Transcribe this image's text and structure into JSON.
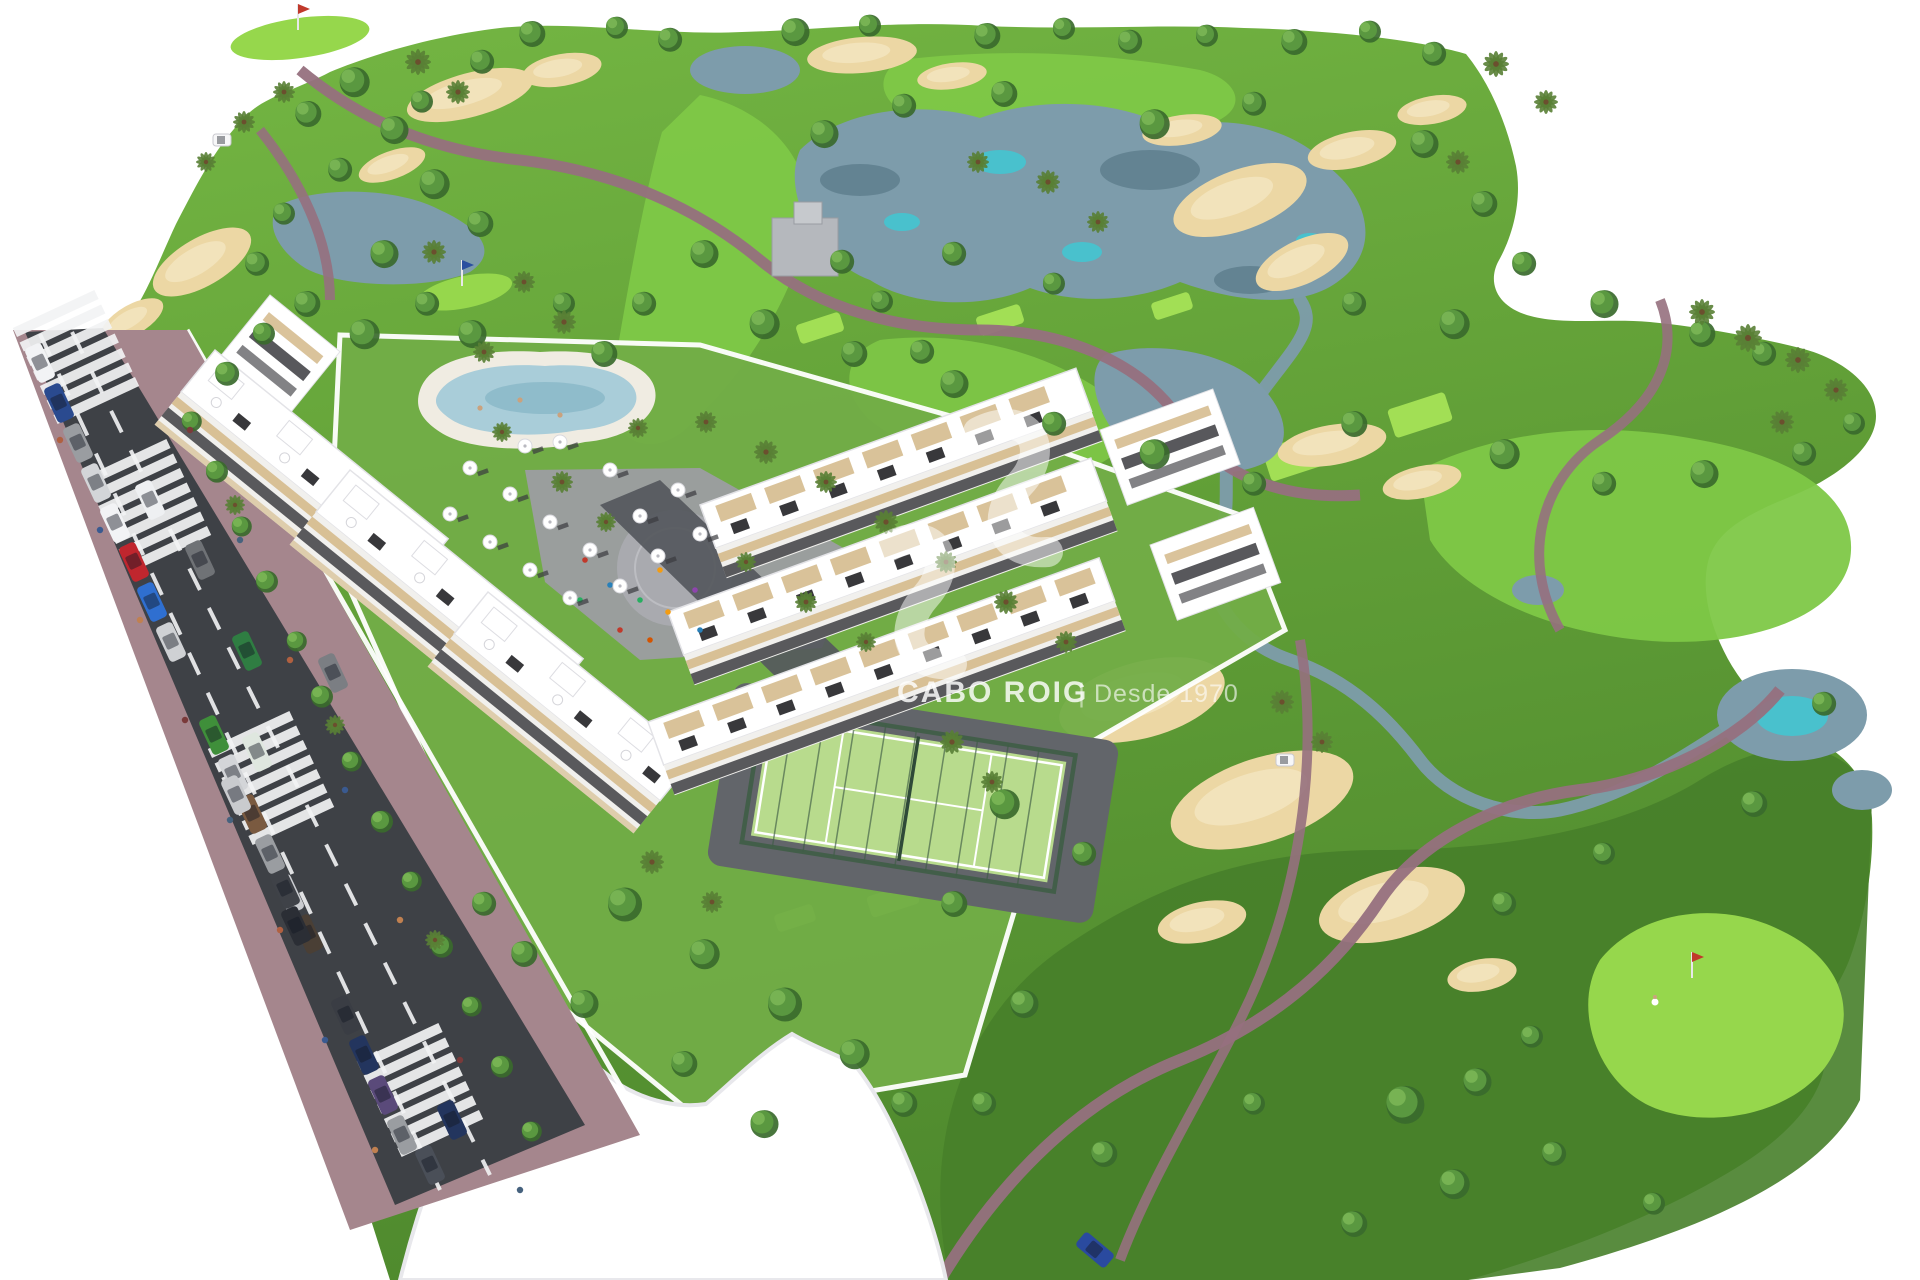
{
  "watermark": {
    "brand": "CABO ROIG",
    "divider": "|",
    "tagline": "Desde 1970",
    "logo": "sv-swoosh-icon"
  },
  "palette": {
    "bg": "#ffffff",
    "course_top": "#74b643",
    "course_mid": "#619f37",
    "course_low": "#4f8a2e",
    "rough_dark": "#47802a",
    "fairway": "#7ec847",
    "green_bright": "#96d74c",
    "tee": "#a2df55",
    "sand": "#ecd7a4",
    "sand_light": "#f4e6c0",
    "water": "#7d9cab",
    "water_deep": "#5d7d8c",
    "water_teal": "#3fc8d2",
    "path": "#96707e",
    "road": "#3e4146",
    "road_line": "#f2f3f4",
    "sidewalk": "#a5868d",
    "parcel": "#72ad47",
    "wall": "#ffffff",
    "wall_shadow": "#e8e8ec",
    "plaza": "#9c9da2",
    "plaza_inner": "#a9aaaf",
    "pool_deck": "#f0ece2",
    "pool_water": "#a9cdd9",
    "pool_deep": "#7fb0c2",
    "court": "#b8db8d",
    "court_line": "#ffffff",
    "fence": "#3f5d46",
    "apron": "#62656a",
    "drive": "#55585d",
    "building": "#ffffff",
    "building_line": "#e3e3e7",
    "facade_shade": "#f1f0ed",
    "facade_beige": "#d6bd90",
    "window_dark": "#2e2e33",
    "panel_black": "#1d1d20",
    "tree_dark": "#3a6a2d",
    "tree_mid": "#5a9840",
    "tree_light": "#7cb757",
    "palm": "#597f35",
    "trunk": "#6b4f2e",
    "stone": "#b5b8bd",
    "cart": "#f7f7f8",
    "skin": "#caa27e"
  },
  "scene": {
    "trees": [
      [
        530,
        32,
        13
      ],
      [
        615,
        26,
        11
      ],
      [
        668,
        38,
        12
      ],
      [
        793,
        30,
        14
      ],
      [
        868,
        24,
        11
      ],
      [
        985,
        34,
        13
      ],
      [
        1062,
        27,
        11
      ],
      [
        1128,
        40,
        12
      ],
      [
        1205,
        34,
        11
      ],
      [
        1292,
        40,
        13
      ],
      [
        1368,
        30,
        11
      ],
      [
        1432,
        52,
        12
      ],
      [
        480,
        60,
        12
      ],
      [
        420,
        100,
        11
      ],
      [
        352,
        80,
        15
      ],
      [
        306,
        112,
        13
      ],
      [
        392,
        128,
        14
      ],
      [
        338,
        168,
        12
      ],
      [
        432,
        182,
        15
      ],
      [
        478,
        222,
        13
      ],
      [
        282,
        212,
        11
      ],
      [
        255,
        262,
        12
      ],
      [
        382,
        252,
        14
      ],
      [
        305,
        302,
        13
      ],
      [
        362,
        332,
        15
      ],
      [
        425,
        302,
        12
      ],
      [
        262,
        332,
        11
      ],
      [
        225,
        372,
        12
      ],
      [
        470,
        332,
        14
      ],
      [
        822,
        132,
        14
      ],
      [
        902,
        104,
        12
      ],
      [
        1002,
        92,
        13
      ],
      [
        1152,
        122,
        15
      ],
      [
        1252,
        102,
        12
      ],
      [
        1422,
        142,
        14
      ],
      [
        1482,
        202,
        13
      ],
      [
        1522,
        262,
        12
      ],
      [
        1602,
        302,
        14
      ],
      [
        1700,
        332,
        13
      ],
      [
        1762,
        352,
        12
      ],
      [
        1452,
        322,
        15
      ],
      [
        1352,
        302,
        12
      ],
      [
        1052,
        282,
        11
      ],
      [
        952,
        252,
        12
      ],
      [
        702,
        252,
        14
      ],
      [
        642,
        302,
        12
      ],
      [
        602,
        352,
        13
      ],
      [
        562,
        302,
        11
      ],
      [
        762,
        322,
        15
      ],
      [
        852,
        352,
        13
      ],
      [
        952,
        382,
        14
      ],
      [
        1052,
        422,
        12
      ],
      [
        1152,
        452,
        15
      ],
      [
        1252,
        482,
        12
      ],
      [
        1352,
        422,
        13
      ],
      [
        1502,
        452,
        15
      ],
      [
        1602,
        482,
        12
      ],
      [
        1702,
        472,
        14
      ],
      [
        1802,
        452,
        12
      ],
      [
        1852,
        422,
        11
      ],
      [
        920,
        350,
        12
      ],
      [
        880,
        300,
        11
      ],
      [
        840,
        260,
        12
      ],
      [
        1002,
        802,
        15
      ],
      [
        1082,
        852,
        12
      ],
      [
        952,
        902,
        13
      ],
      [
        1022,
        1002,
        14
      ],
      [
        982,
        1102,
        12
      ],
      [
        1102,
        1152,
        13
      ],
      [
        1252,
        1102,
        11
      ],
      [
        1402,
        1102,
        19
      ],
      [
        1452,
        1182,
        15
      ],
      [
        1352,
        1222,
        13
      ],
      [
        1552,
        1152,
        12
      ],
      [
        1652,
        1202,
        11
      ],
      [
        1502,
        902,
        12
      ],
      [
        1602,
        852,
        11
      ],
      [
        1752,
        802,
        13
      ],
      [
        1822,
        702,
        12
      ],
      [
        1475,
        1080,
        14
      ],
      [
        1530,
        1035,
        11
      ],
      [
        622,
        902,
        17
      ],
      [
        702,
        952,
        15
      ],
      [
        782,
        1002,
        17
      ],
      [
        852,
        1052,
        15
      ],
      [
        902,
        1102,
        13
      ],
      [
        762,
        1122,
        14
      ],
      [
        682,
        1062,
        13
      ],
      [
        582,
        1002,
        14
      ],
      [
        522,
        952,
        13
      ],
      [
        482,
        902,
        12
      ],
      [
        190,
        420,
        10
      ],
      [
        215,
        470,
        11
      ],
      [
        240,
        525,
        10
      ],
      [
        265,
        580,
        11
      ],
      [
        295,
        640,
        10
      ],
      [
        320,
        695,
        11
      ],
      [
        350,
        760,
        10
      ],
      [
        380,
        820,
        11
      ],
      [
        410,
        880,
        10
      ],
      [
        440,
        945,
        11
      ],
      [
        470,
        1005,
        10
      ],
      [
        500,
        1065,
        11
      ],
      [
        530,
        1130,
        10
      ]
    ],
    "palms": [
      [
        418,
        62,
        13
      ],
      [
        458,
        92,
        12
      ],
      [
        1496,
        64,
        13
      ],
      [
        1546,
        102,
        12
      ],
      [
        1458,
        162,
        12
      ],
      [
        244,
        122,
        11
      ],
      [
        206,
        162,
        10
      ],
      [
        284,
        92,
        11
      ],
      [
        1702,
        312,
        13
      ],
      [
        1748,
        338,
        14
      ],
      [
        1798,
        360,
        13
      ],
      [
        1836,
        390,
        12
      ],
      [
        1782,
        422,
        12
      ],
      [
        434,
        252,
        12
      ],
      [
        524,
        282,
        11
      ],
      [
        564,
        322,
        12
      ],
      [
        484,
        352,
        11
      ],
      [
        638,
        428,
        10
      ],
      [
        1048,
        182,
        12
      ],
      [
        1098,
        222,
        11
      ],
      [
        978,
        162,
        11
      ],
      [
        706,
        422,
        11
      ],
      [
        766,
        452,
        12
      ],
      [
        826,
        482,
        11
      ],
      [
        886,
        522,
        12
      ],
      [
        946,
        562,
        11
      ],
      [
        1006,
        602,
        12
      ],
      [
        1066,
        642,
        11
      ],
      [
        746,
        562,
        10
      ],
      [
        806,
        602,
        11
      ],
      [
        866,
        642,
        10
      ],
      [
        562,
        482,
        11
      ],
      [
        606,
        522,
        10
      ],
      [
        502,
        432,
        10
      ],
      [
        1282,
        702,
        12
      ],
      [
        1322,
        742,
        11
      ],
      [
        652,
        862,
        12
      ],
      [
        712,
        902,
        11
      ],
      [
        952,
        742,
        12
      ],
      [
        992,
        782,
        11
      ],
      [
        235,
        505,
        10
      ],
      [
        335,
        725,
        10
      ],
      [
        435,
        940,
        10
      ]
    ],
    "cars_parked": [
      [
        40,
        363,
        "#f2f3f5"
      ],
      [
        59,
        403,
        "#2a4a8f"
      ],
      [
        78,
        443,
        "#9a9da1"
      ],
      [
        96,
        483,
        "#d3d5d8"
      ],
      [
        115,
        523,
        "#f2f3f5"
      ],
      [
        134,
        562,
        "#c0262e"
      ],
      [
        152,
        602,
        "#2f6fd0"
      ],
      [
        171,
        642,
        "#cfd1d4"
      ],
      [
        214,
        735,
        "#3f8f3a"
      ],
      [
        233,
        774,
        "#d3d5d8"
      ],
      [
        252,
        814,
        "#7a5a40"
      ],
      [
        270,
        854,
        "#9a9da1"
      ],
      [
        289,
        894,
        "#caccd0"
      ],
      [
        308,
        934,
        "#4a3f35"
      ],
      [
        346,
        1015,
        "#3a3d44"
      ],
      [
        364,
        1055,
        "#23355e"
      ],
      [
        383,
        1095,
        "#5a4a7a"
      ],
      [
        402,
        1135,
        "#9a9da1"
      ]
    ],
    "cars_moving": [
      [
        150,
        500,
        "#eef0f2"
      ],
      [
        200,
        560,
        "#6f7276"
      ],
      [
        247,
        651,
        "#2f7d42"
      ],
      [
        257,
        752,
        "#dfe7df"
      ],
      [
        236,
        795,
        "#c9cbce"
      ],
      [
        285,
        889,
        "#3f4248"
      ],
      [
        296,
        926,
        "#2b2e35"
      ],
      [
        452,
        1120,
        "#23355e"
      ],
      [
        430,
        1165,
        "#4a4f58"
      ],
      [
        333,
        673,
        "#7b7e83"
      ],
      [
        1095,
        1250,
        "#2a4a9f",
        40
      ]
    ],
    "crosswalks": [
      [
        76,
        357
      ],
      [
        148,
        506
      ],
      [
        271,
        778
      ],
      [
        420,
        1090
      ]
    ],
    "pedestrians": [
      [
        60,
        440,
        "#b06040"
      ],
      [
        100,
        530,
        "#3a5a90"
      ],
      [
        140,
        620,
        "#c08050"
      ],
      [
        185,
        720,
        "#7a3a3a"
      ],
      [
        230,
        820,
        "#46627e"
      ],
      [
        280,
        930,
        "#b06040"
      ],
      [
        325,
        1040,
        "#3a5a90"
      ],
      [
        375,
        1150,
        "#c08050"
      ],
      [
        190,
        430,
        "#7a3a3a"
      ],
      [
        240,
        540,
        "#46627e"
      ],
      [
        290,
        660,
        "#b06040"
      ],
      [
        345,
        790,
        "#3a5a90"
      ],
      [
        400,
        920,
        "#c08050"
      ],
      [
        460,
        1060,
        "#7a3a3a"
      ],
      [
        520,
        1190,
        "#46627e"
      ]
    ],
    "plaza_people": [
      [
        585,
        560
      ],
      [
        610,
        585
      ],
      [
        640,
        600
      ],
      [
        668,
        612
      ],
      [
        695,
        590
      ],
      [
        650,
        640
      ],
      [
        620,
        630
      ],
      [
        700,
        630
      ],
      [
        580,
        600
      ],
      [
        660,
        570
      ]
    ],
    "people_colors": [
      "#c0392b",
      "#2980b9",
      "#27ae60",
      "#f39c12",
      "#8e44ad",
      "#d35400"
    ],
    "pool_people": [
      [
        520,
        400
      ],
      [
        560,
        415
      ],
      [
        480,
        408
      ]
    ],
    "umbrellas": [
      [
        470,
        468
      ],
      [
        510,
        494
      ],
      [
        550,
        522
      ],
      [
        590,
        550
      ],
      [
        450,
        514
      ],
      [
        490,
        542
      ],
      [
        530,
        570
      ],
      [
        570,
        598
      ],
      [
        620,
        586
      ],
      [
        658,
        556
      ],
      [
        640,
        516
      ],
      [
        678,
        490
      ],
      [
        700,
        534
      ],
      [
        610,
        470
      ],
      [
        560,
        442
      ],
      [
        525,
        446
      ]
    ],
    "tees": [
      [
        820,
        328,
        46,
        20
      ],
      [
        1000,
        320,
        46,
        20
      ],
      [
        1172,
        306,
        40,
        18
      ],
      [
        893,
        900,
        50,
        22
      ],
      [
        795,
        918,
        40,
        18
      ],
      [
        1300,
        455,
        70,
        34
      ],
      [
        1420,
        415,
        60,
        30
      ]
    ],
    "flags": [
      [
        298,
        30,
        "#c0392b"
      ],
      [
        462,
        286,
        "#2b4fa0"
      ],
      [
        1692,
        978,
        "#c0392b"
      ]
    ],
    "golfer": [
      1655,
      1002
    ],
    "carts": [
      [
        1285,
        760
      ],
      [
        222,
        140
      ]
    ],
    "bunkers": [
      [
        470,
        95,
        65,
        22,
        -15
      ],
      [
        562,
        70,
        40,
        16,
        -10
      ],
      [
        862,
        55,
        55,
        18,
        -5
      ],
      [
        952,
        76,
        35,
        13,
        -8
      ],
      [
        1240,
        200,
        70,
        30,
        -20
      ],
      [
        1302,
        262,
        50,
        22,
        -25
      ],
      [
        1352,
        150,
        45,
        18,
        -12
      ],
      [
        1432,
        110,
        35,
        14,
        -10
      ],
      [
        1182,
        130,
        40,
        15,
        -8
      ],
      [
        392,
        165,
        35,
        14,
        -20
      ],
      [
        202,
        262,
        55,
        24,
        -30
      ],
      [
        132,
        320,
        35,
        15,
        -30
      ],
      [
        1332,
        445,
        55,
        20,
        -10
      ],
      [
        1422,
        482,
        40,
        16,
        -12
      ],
      [
        1142,
        700,
        85,
        38,
        -15
      ],
      [
        1262,
        800,
        95,
        42,
        -18
      ],
      [
        1392,
        905,
        75,
        34,
        -15
      ],
      [
        1202,
        922,
        45,
        20,
        -12
      ],
      [
        1482,
        975,
        35,
        16,
        -10
      ]
    ],
    "ponds": [
      [
        745,
        70,
        55,
        24
      ],
      [
        1792,
        715,
        75,
        46
      ],
      [
        1862,
        790,
        30,
        20
      ],
      [
        1538,
        590,
        26,
        15
      ]
    ],
    "water_teal_patches": [
      [
        1000,
        162,
        26,
        12
      ],
      [
        1082,
        252,
        20,
        10
      ],
      [
        902,
        222,
        18,
        9
      ],
      [
        1252,
        198,
        22,
        10
      ],
      [
        1310,
        240,
        14,
        7
      ],
      [
        1792,
        716,
        36,
        20
      ],
      [
        1062,
        578,
        16,
        8
      ]
    ],
    "water_dark_patches": [
      [
        860,
        180,
        40,
        16
      ],
      [
        1150,
        170,
        50,
        20
      ],
      [
        1250,
        280,
        36,
        14
      ],
      [
        1190,
        420,
        30,
        12
      ]
    ],
    "blocks": [
      {
        "x": 270,
        "y": 295,
        "rot": 39,
        "len": 90,
        "type": "T"
      },
      {
        "x": 215,
        "y": 350,
        "rot": 39,
        "len": 300,
        "type": "A"
      },
      {
        "x": 350,
        "y": 470,
        "rot": 39,
        "len": 300,
        "type": "A"
      },
      {
        "x": 488,
        "y": 592,
        "rot": 39,
        "len": 265,
        "type": "A"
      },
      {
        "x": 700,
        "y": 505,
        "rot": -20,
        "len": 400,
        "type": "B"
      },
      {
        "x": 668,
        "y": 612,
        "rot": -20,
        "len": 450,
        "type": "B"
      },
      {
        "x": 648,
        "y": 722,
        "rot": -20,
        "len": 480,
        "type": "B"
      },
      {
        "x": 1100,
        "y": 430,
        "rot": -20,
        "len": 120,
        "type": "T"
      },
      {
        "x": 1150,
        "y": 545,
        "rot": -20,
        "len": 110,
        "type": "T"
      }
    ]
  }
}
